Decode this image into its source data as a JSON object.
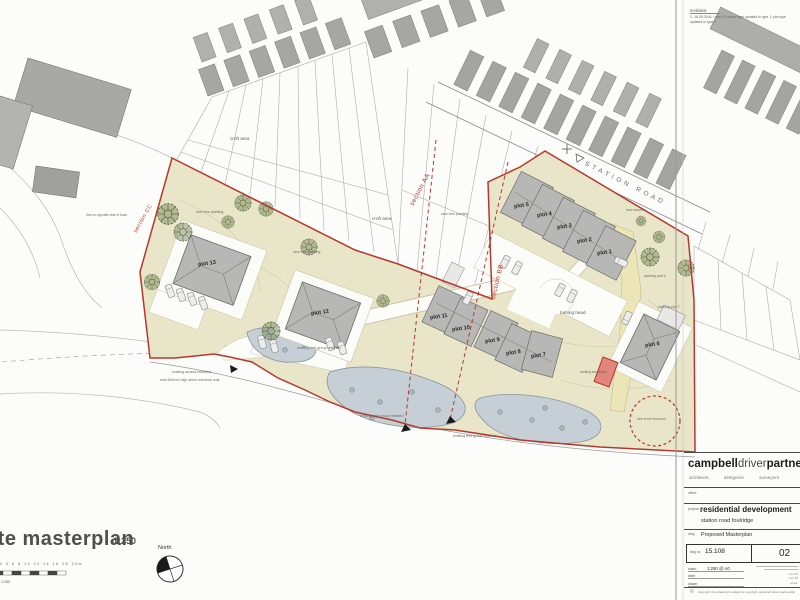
{
  "map": {
    "road_name": "STATION ROAD",
    "sections": {
      "aa": "section AA",
      "bb": "section BB",
      "cc": "section CC"
    },
    "croft_area": "croft area",
    "new_tree": "new tree planting",
    "tree_opposite": "tree on opposite side of track",
    "access_modified": "existing access modified",
    "stone_wall": "new 600mm high stone entrance wall",
    "tree_group": "existing tree group retained",
    "turning_head": "turning head",
    "parking_plot_6": "parking plot 6",
    "parking_plot_7": "parking plot 7",
    "new_access": "new access",
    "sub_station": "existing sub station",
    "tree_removed": "tree to be removed",
    "plots": [
      "plot 1",
      "plot 2",
      "plot 3",
      "plot 4",
      "plot 5",
      "plot 6",
      "plot 7",
      "plot 8",
      "plot 9",
      "plot 10",
      "plot 11",
      "plot 12",
      "plot 13"
    ]
  },
  "footer": {
    "title": "site masterplan",
    "title_scale": "1:250",
    "north": "North",
    "scalebar_numbers": "2 4 6 8 10 12 14 16 18 20m",
    "scalebar_scale": "1:250"
  },
  "titleblock": {
    "revisions_heading": "revisions",
    "revision_note": "C: 16.05.29 AL / plot 1-9 house type updated to type 1; plot type updated to type 7",
    "firm_part1": "campbell",
    "firm_part2": "driver",
    "firm_part3": "partnership",
    "disciplines": "architects designers surveyors",
    "client_label": "client:",
    "project_label": "project:",
    "project_name": "residential development",
    "project_location": "station road   foulridge",
    "drawing_label": "dwg:",
    "drawing_name": "Proposed Masterplan",
    "dwg_no_label": "dwg no:",
    "dwg_no": "15.108",
    "revision": "02",
    "scale_label": "scale:",
    "scale_value": "1:250   @ A0",
    "date_label": "date:",
    "drawn_label": "drawn:",
    "contact_lines": [
      "t: 01 25",
      "f: 01 25",
      "email:"
    ],
    "copyright": "copyright: this drawing is subject to copyright. campbell driver partnership",
    "copyright_symbol": "©"
  }
}
